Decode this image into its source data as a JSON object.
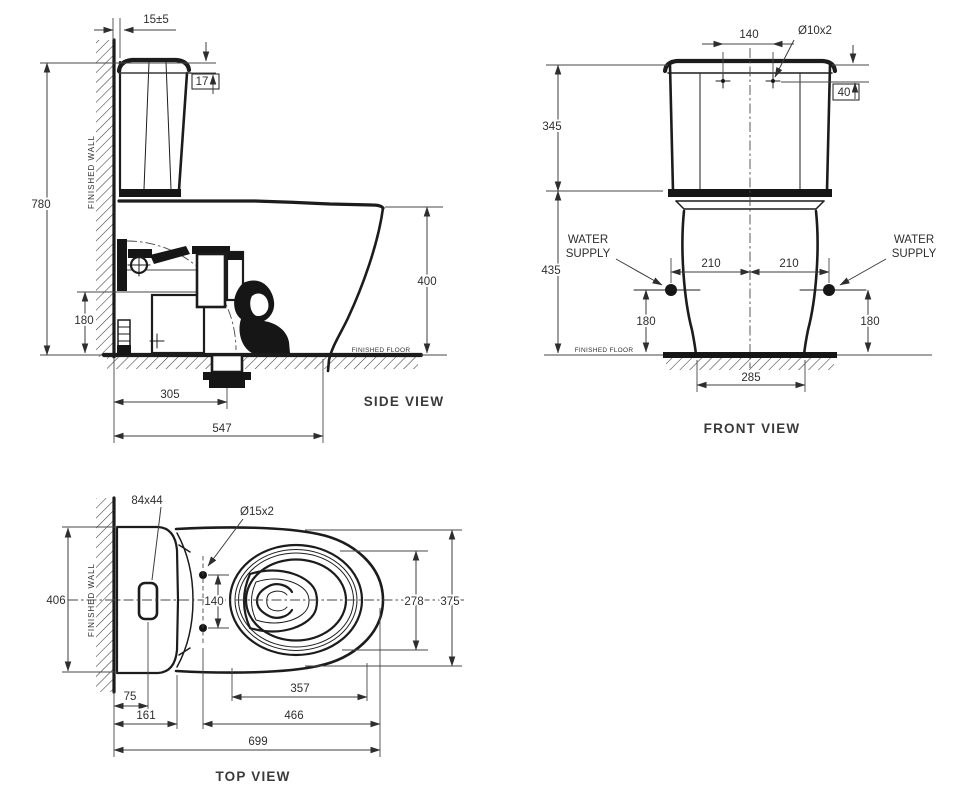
{
  "meta": {
    "background": "#ffffff",
    "line_color": "#1c1c1c",
    "dim_line_color": "#3c3c3c",
    "text_color": "#2e2e2e"
  },
  "side_view": {
    "label": "SIDE VIEW",
    "finished_wall": "FINISHED WALL",
    "finished_floor": "FINISHED FLOOR",
    "dims": {
      "wall_gap": "15±5",
      "lid_drop": "17",
      "total_height": "780",
      "rim_height": "400",
      "inlet_height": "180",
      "outlet_offset": "305",
      "total_depth": "547"
    }
  },
  "front_view": {
    "label": "FRONT VIEW",
    "finished_floor": "FINISHED FLOOR",
    "water_supply": {
      "line1": "WATER",
      "line2": "SUPPLY"
    },
    "dims": {
      "bolt_spacing": "140",
      "bolt_holes": "Ø10x2",
      "bolt_drop": "40",
      "tank_height": "345",
      "rim_to_floor": "435",
      "supply_offset_left": "210",
      "supply_offset_right": "210",
      "supply_height_left": "180",
      "supply_height_right": "180",
      "base_width": "285"
    }
  },
  "top_view": {
    "label": "TOP VIEW",
    "finished_wall": "FINISHED WALL",
    "dims": {
      "button_size": "84x44",
      "seat_holes": "Ø15x2",
      "overall_width": "406",
      "hole_spacing": "140",
      "inner_rim_width": "278",
      "bowl_width": "375",
      "button_offset": "75",
      "tank_front_offset": "161",
      "bowl_opening_length": "357",
      "hole_to_front": "466",
      "total_length": "699"
    }
  }
}
